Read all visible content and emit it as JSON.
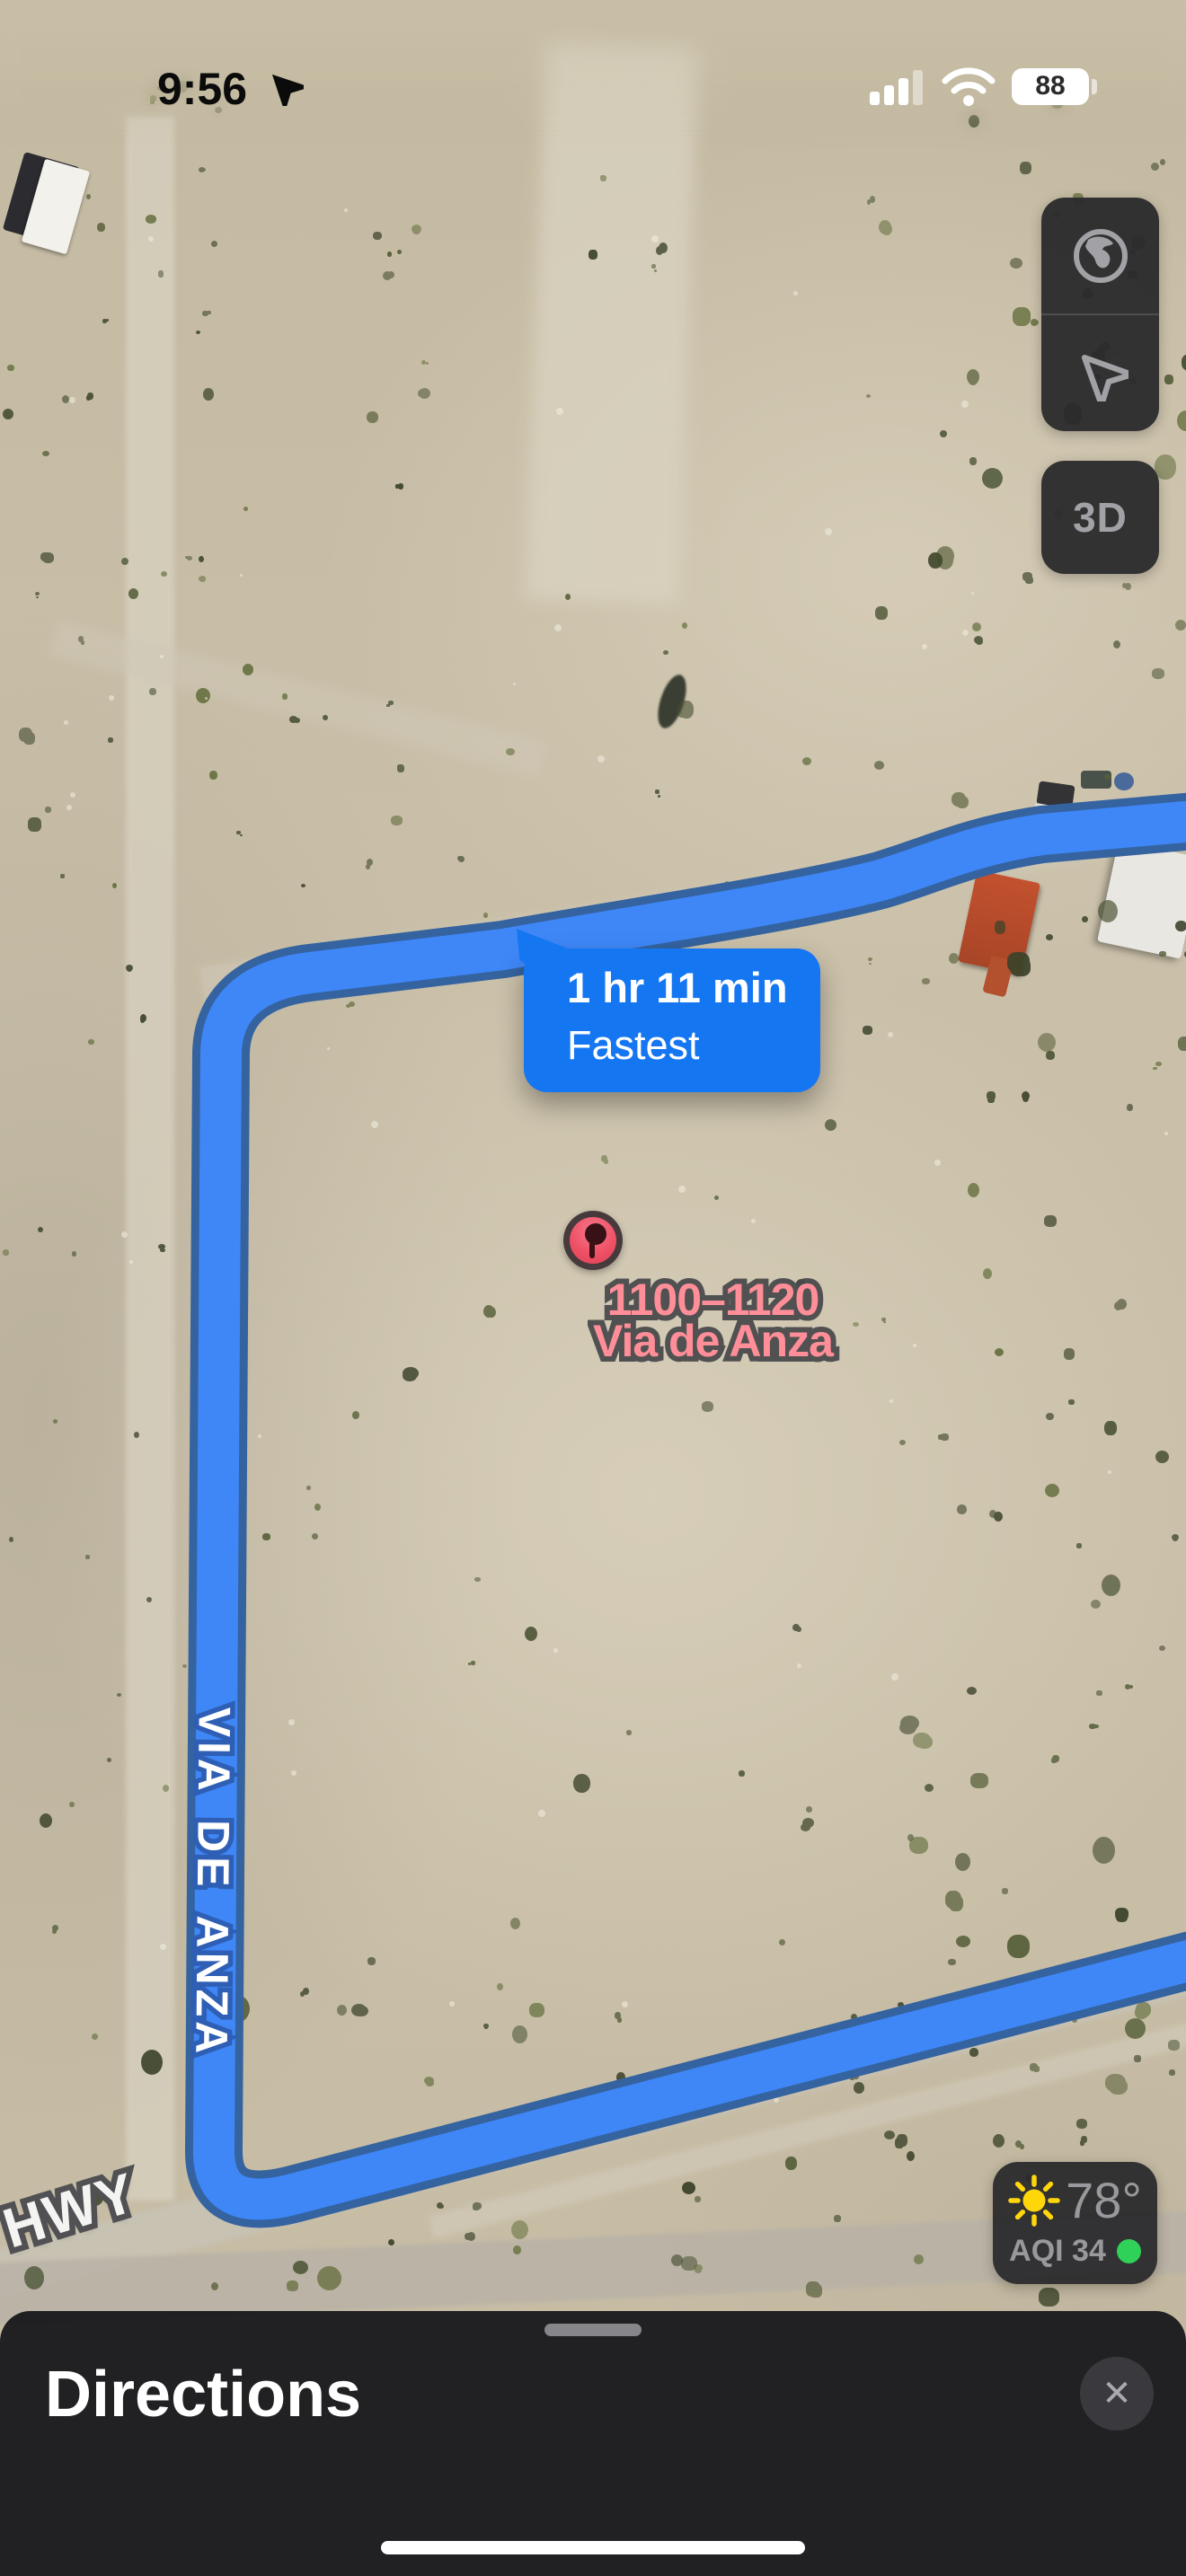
{
  "status_bar": {
    "time": "9:56",
    "battery": "88"
  },
  "map_controls": {
    "three_d_label": "3D"
  },
  "route_callout": {
    "duration": "1 hr 11 min",
    "mode": "Fastest"
  },
  "destination_pin": {
    "line1": "1100–1120",
    "line2": "Via de Anza"
  },
  "road_labels": {
    "via_de_anza": "VIA DE ANZA",
    "hwy": "HWY"
  },
  "weather_widget": {
    "temperature": "78°",
    "aqi": "AQI 34"
  },
  "directions_sheet": {
    "title": "Directions",
    "close_icon": "✕"
  },
  "colors": {
    "route_fill": "#3F87F7",
    "route_casing": "#35639F",
    "callout_blue": "#1576F2",
    "pin_red": "#EF5266",
    "label_pink": "#FF8E98",
    "aqi_green": "#2FD158",
    "sun_yellow": "#FFD60A",
    "sheet_bg": "#1E1E20"
  }
}
